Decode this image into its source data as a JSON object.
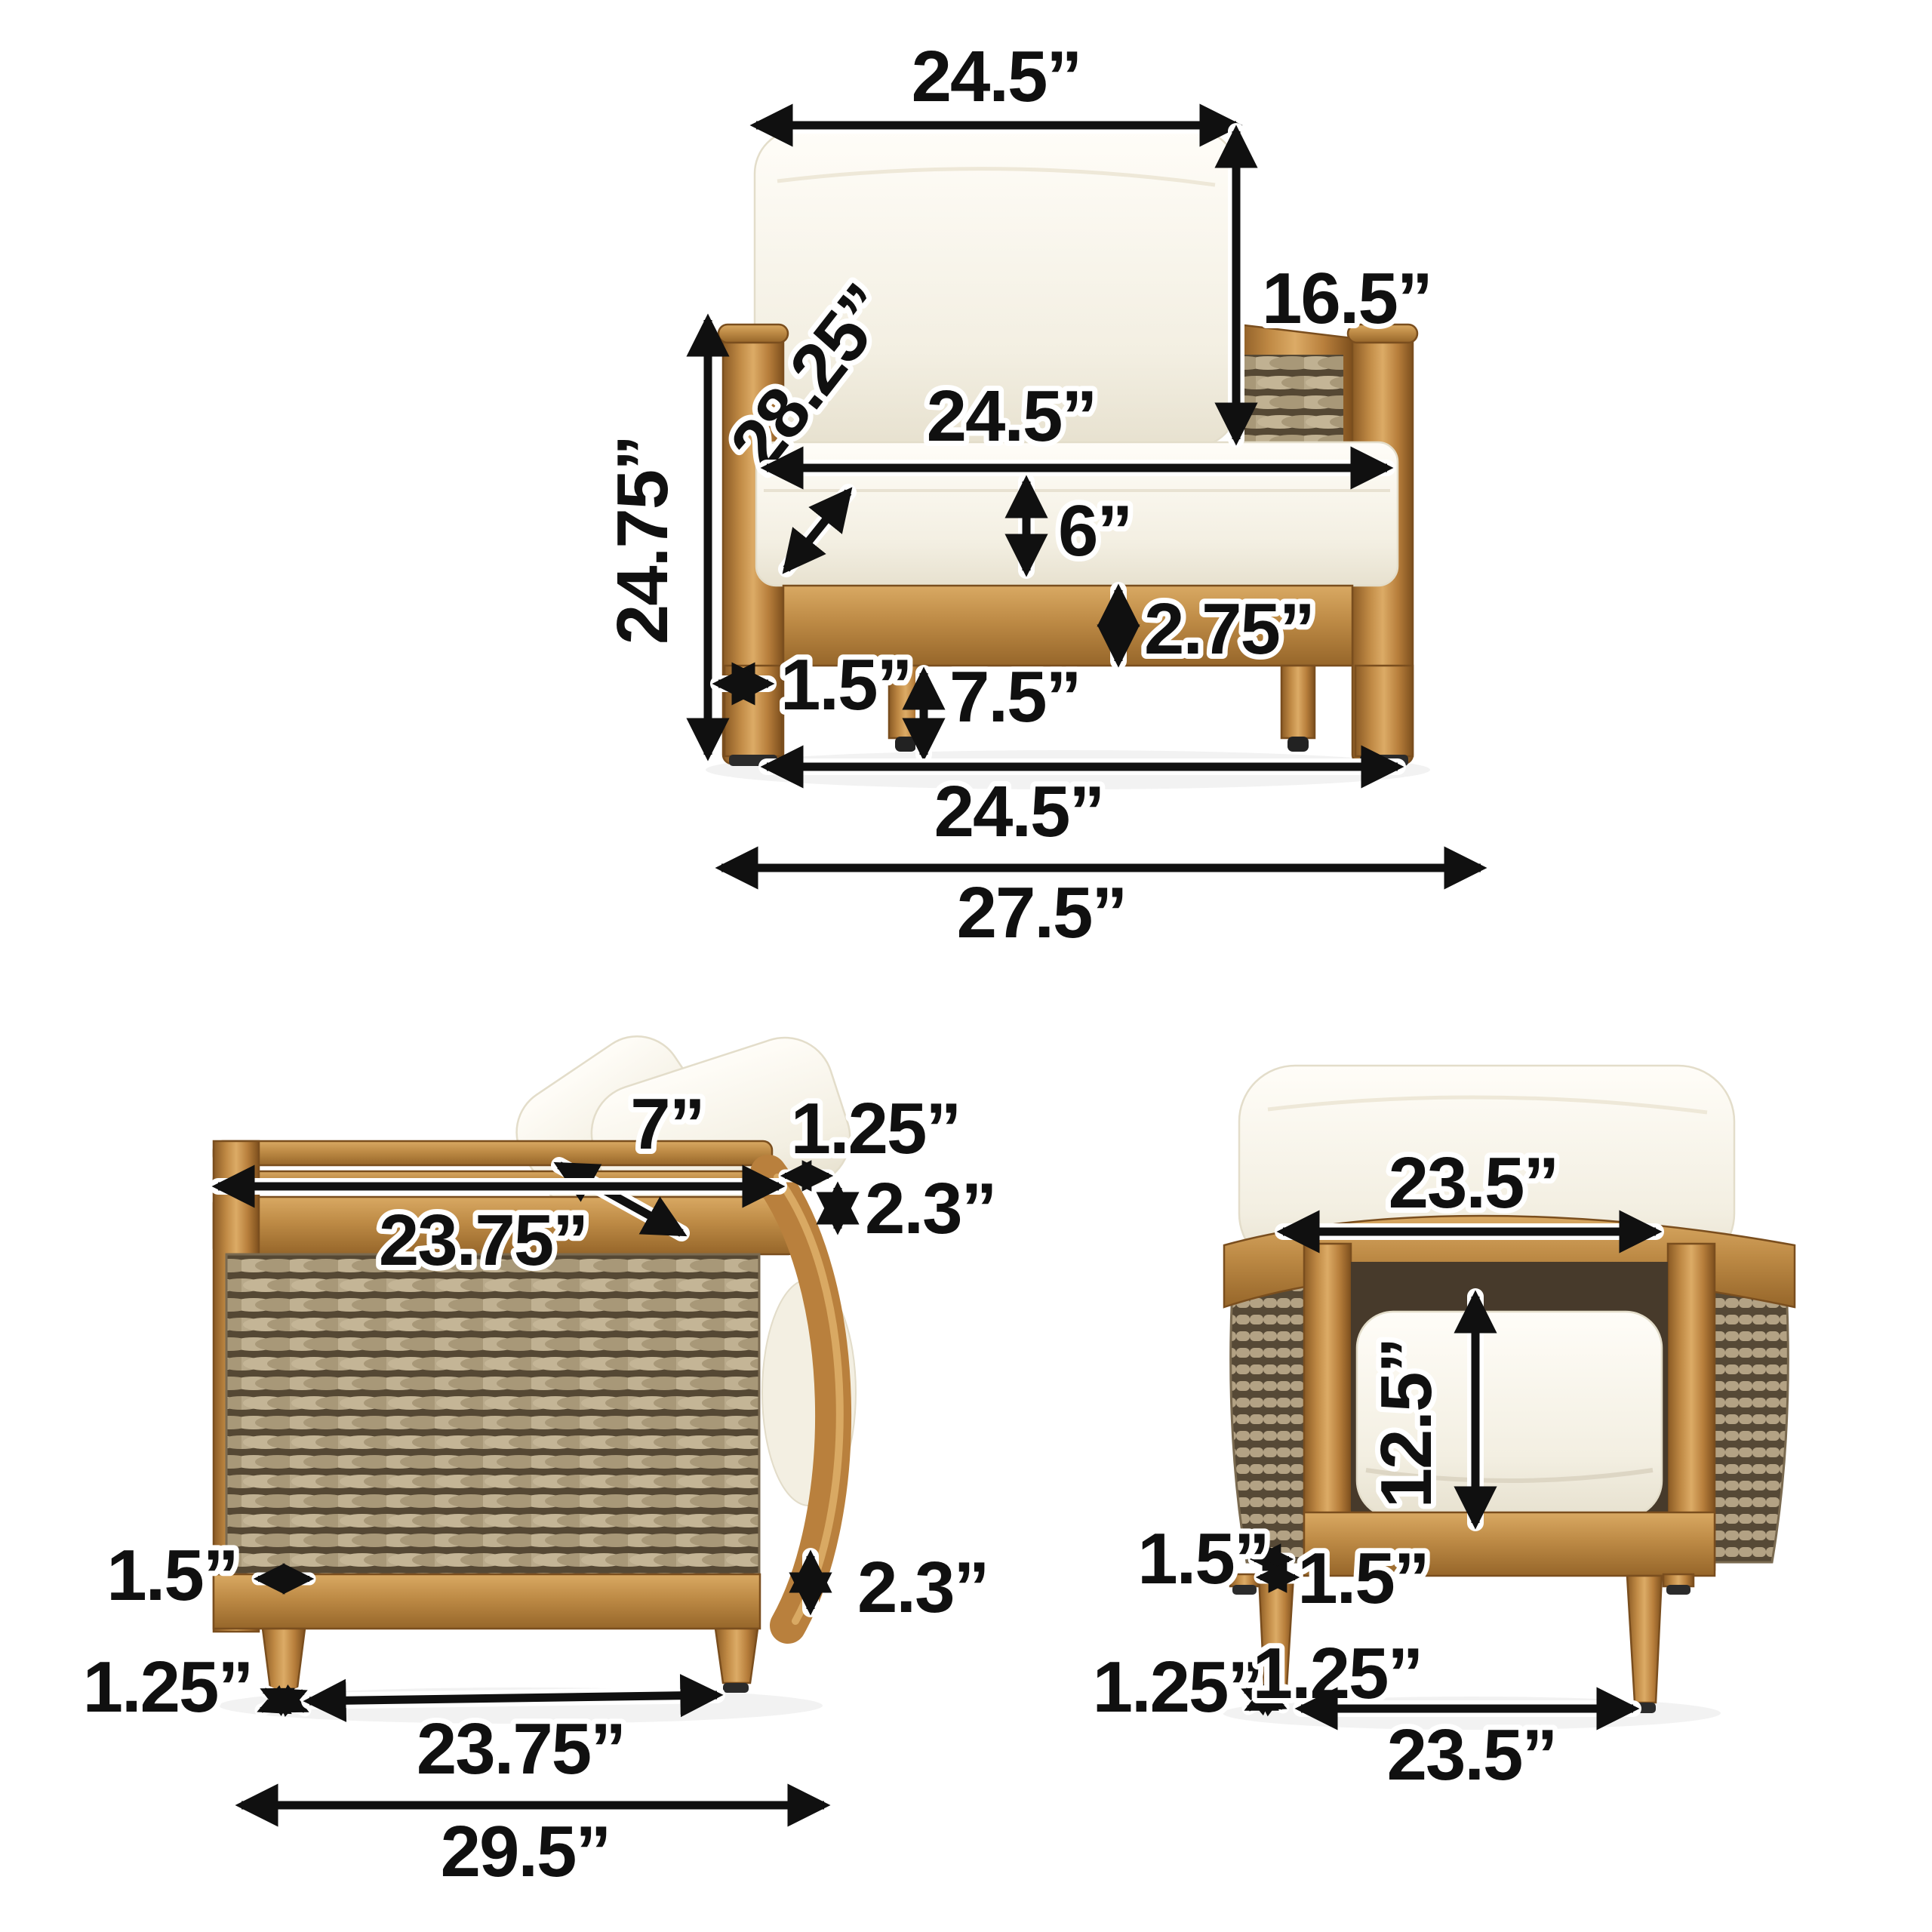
{
  "image_type": "product-dimension-diagram",
  "product": "wicker barrel club chair with cushions",
  "colors": {
    "background": "#ffffff",
    "dimension_line": "#101010",
    "label_outline": "#ffffff",
    "wood": "#c08a45",
    "wood_dark": "#8a5a24",
    "wood_light": "#dcab66",
    "wicker": "#b3a284",
    "wicker_shadow": "#564936",
    "cushion": "#f7f3e8"
  },
  "views": {
    "front": {
      "title": "front view",
      "dims": {
        "back_cushion_width": "24.5”",
        "back_cushion_height": "16.5”",
        "arm_diagonal": "28.25”",
        "overall_height": "24.75”",
        "seat_width": "24.5”",
        "seat_thickness": "6”",
        "apron_height": "2.75”",
        "leg_width": "1.5”",
        "under_clearance": "7.5”",
        "base_width": "24.5”",
        "overall_width": "27.5”"
      }
    },
    "side": {
      "title": "side view",
      "dims": {
        "pillow_thickness": "7”",
        "rim_lip": "1.25”",
        "rim_height_top": "2.3”",
        "depth_top": "23.75”",
        "rim_height_bottom": "2.3”",
        "leg_width": "1.5”",
        "foot_height": "1.25”",
        "base_depth": "23.75”",
        "overall_depth": "29.5”"
      }
    },
    "back": {
      "title": "back view",
      "dims": {
        "back_width": "23.5”",
        "back_opening_height": "12.5”",
        "leg_width_rear": "1.5”",
        "leg_width_front": "1.5”",
        "foot_height_rear": "1.25”",
        "foot_height_front": "1.25”",
        "base_width": "23.5”"
      }
    }
  }
}
